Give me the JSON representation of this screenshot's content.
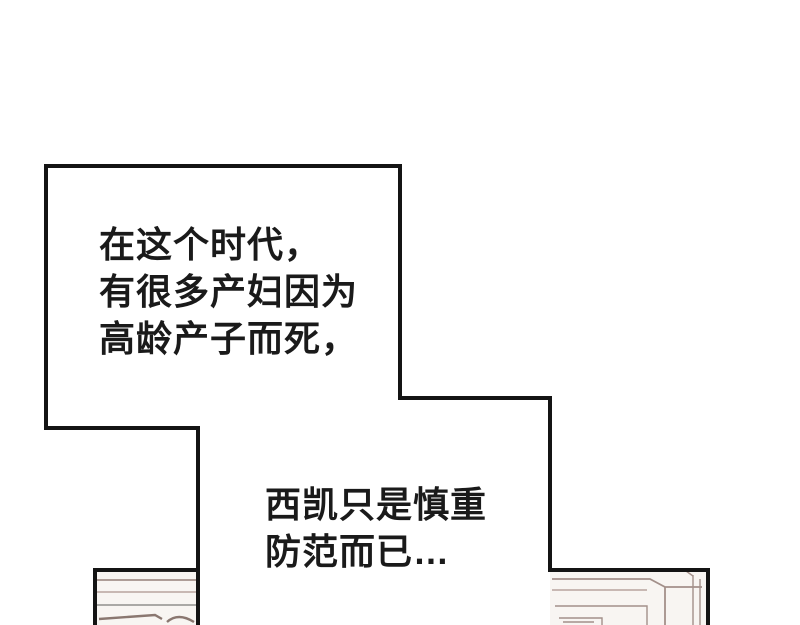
{
  "theme": {
    "paper": "#ffffff",
    "ink": "#141414",
    "text": "#1a1a1a",
    "art_line": "#a3908a",
    "art_line_soft": "#b7a49e",
    "art_line_gray": "#90908c",
    "art_line_dark": "#8a7770",
    "art_bg": "#f8f5f2"
  },
  "captions": {
    "box": {
      "lines": [
        "在这个时代，",
        "有很多产妇因为",
        "高龄产子而死，"
      ]
    },
    "floating": {
      "lines": [
        "西凯只是慎重",
        "防范而已…"
      ]
    }
  },
  "art": {
    "left_window": "window-frame-art",
    "right_window": "window-frame-corner-art",
    "panel_outline": "comic-panel-border"
  }
}
